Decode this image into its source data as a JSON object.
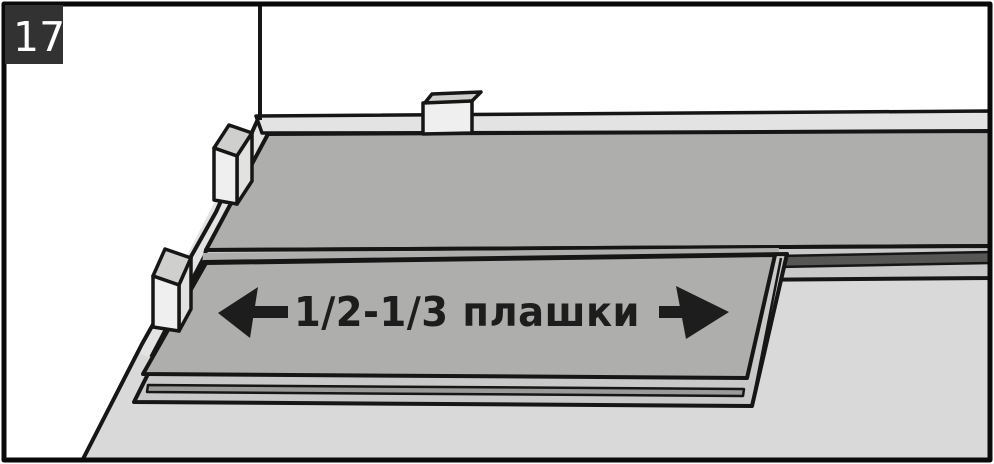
{
  "figure": {
    "step_number": "17",
    "caption": {
      "text": "1/2-1/3 плашки"
    },
    "scene": {
      "description": "laminate plank rows laid along wall with expansion spacers",
      "plank_rows": 2,
      "spacers": 3
    }
  },
  "colors": {
    "wall": "#ffffff",
    "frame": "#0a0a0a",
    "outline": "#161616",
    "floor": "#d9d9d9",
    "baseboard": "#e3e3e3",
    "plank": "#aeaeac",
    "plank_edge_light": "#c9c9c9",
    "plank_edge_dark": "#565654",
    "plank_edge_mid": "#9a9a98",
    "spacer_front": "#efefef",
    "spacer_top": "#cfcfcd",
    "spacer_side": "#e2e2e0",
    "step_badge_bg": "#323232",
    "step_badge_text": "#ffffff",
    "caption_ink": "#1d1d1d"
  }
}
